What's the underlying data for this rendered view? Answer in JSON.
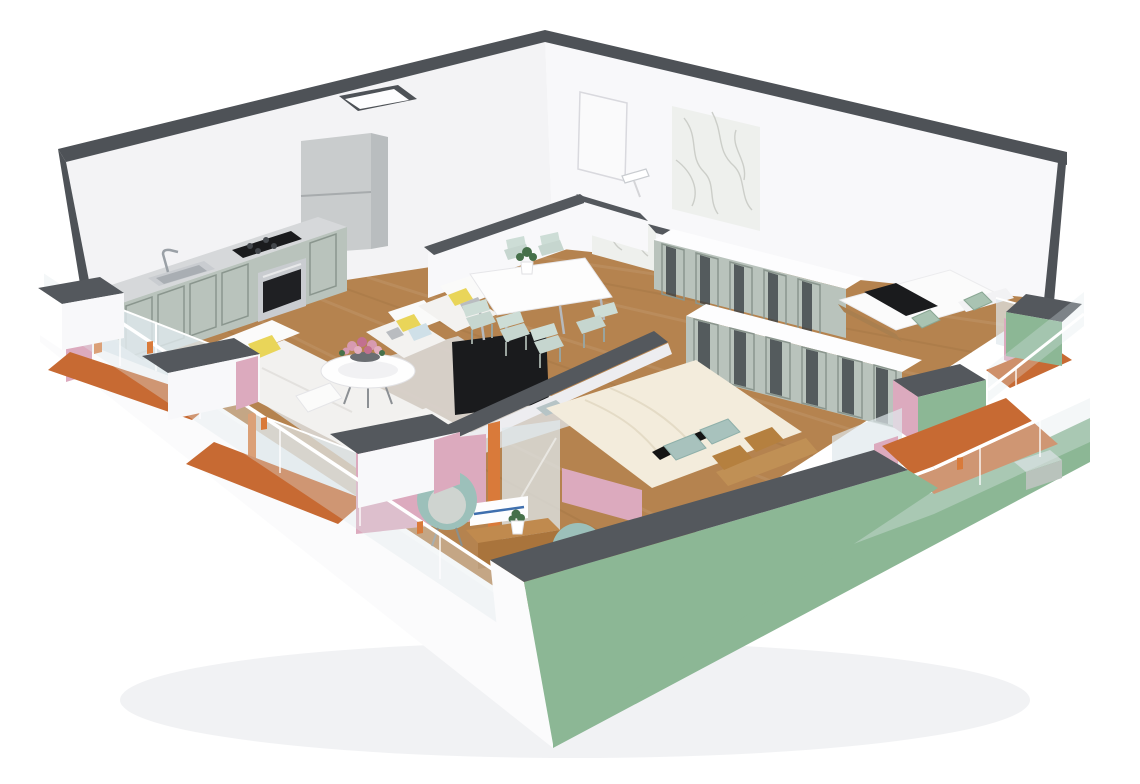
{
  "meta": {
    "title": "3D isometric cutaway floor plan render of an apartment",
    "view": "axonometric from front-above, white background, no visible text"
  },
  "palette": {
    "wall": "#f3f3f5",
    "wallBright": "#f8f8fa",
    "trim": "#4e5257",
    "cap": "#54585d",
    "wood": "#b5834f",
    "rug": "#d8d3cd",
    "sage": "#b9c3bc",
    "sagePanel": "#8a968e",
    "counter": "#d6d8da",
    "steel": "#c9ccd0",
    "dark": "#1a1b1d",
    "orange": "#c76a33",
    "orangeBright": "#d97a3a",
    "pink": "#dcaabe",
    "green": "#8cb795",
    "glassTint": "#dfe8ec",
    "railWhite": "#ffffff",
    "cream": "#f3ecdc",
    "teal": "#a8c2bd",
    "tealChair": "#9cc0ba",
    "brown": "#b5803f",
    "tan": "#c09055",
    "yellow": "#e9d559",
    "blue": "#cfe0e8",
    "gray": "#b9bcc0",
    "white": "#fdfdfe",
    "marble": "#eef0ed",
    "vein": "#c5c8c2",
    "mirror": "#3c4246",
    "plantGreen": "#46704a",
    "flowerPink": "#d79ab0",
    "flowerDeep": "#c2708f"
  },
  "scene": {
    "style": "3d-isometric-cutaway-floor-plan",
    "exterior": {
      "left_walls": "white with dark gray cut tops",
      "right_walls": "green with dark gray cut tops",
      "balcony_floors": "terracotta orange",
      "balcony_inner_walls": "pink",
      "railings": "glass with white handrail and small orange clips"
    },
    "rooms": [
      {
        "name": "open-plan-kitchen-living-dining",
        "floor": "wood",
        "furniture": [
          "sage-kitchen-cabinet-run",
          "stainless-sink",
          "faucet",
          "gas-cooktop",
          "built-in-oven",
          "tall-fridge-cabinet",
          "white-corner-sofa",
          "yellow-gray-white-pillows",
          "two-white-armchairs",
          "round-coffee-table",
          "pink-flower-bouquet",
          "area-rug",
          "black-tv-panel",
          "white-dining-table",
          "six-mint-chairs",
          "potted-plant"
        ]
      },
      {
        "name": "hallway",
        "furniture": [
          "marble-accent-wall",
          "entry-door",
          "wall-niche"
        ]
      },
      {
        "name": "bathroom",
        "furniture": [
          "marble-walls",
          "shower-head"
        ]
      },
      {
        "name": "bedroom-right",
        "floor": "wood",
        "furniture": [
          "bed-white-duvet-black-runner",
          "two-green-pillows",
          "mirrored-sage-wardrobe",
          "balcony-glass-door"
        ]
      },
      {
        "name": "master-bedroom",
        "floor": "wood",
        "furniture": [
          "bed-cream-duvet",
          "teal-pillows",
          "brown-pillows",
          "black-accent-pillows",
          "tan-headboard",
          "mirrored-sage-wardrobe"
        ]
      },
      {
        "name": "loggia-study-nook",
        "walls": "pink",
        "furniture": [
          "teal-tub-chair",
          "second-teal-chair",
          "wooden-desk",
          "succulent-in-white-pot",
          "white-wall-desk-blue-stripe",
          "glass-door-orange-frame"
        ]
      }
    ]
  }
}
